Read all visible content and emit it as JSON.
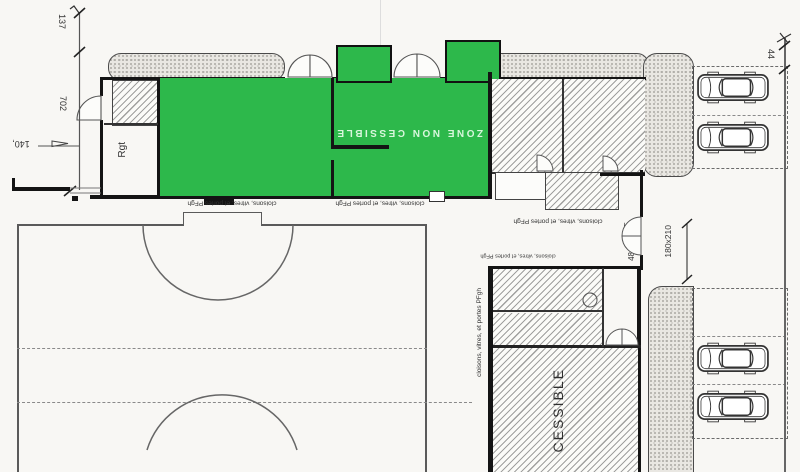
{
  "plan": {
    "green_zone_label": "ZONE NON CESSIBLE",
    "cessible_label": "CESSIBLE",
    "room_label": "Rgt",
    "partition_note": "cloisons, vitres, et portes PFgh",
    "dimensions": {
      "left_upper": "137",
      "left_main": "702",
      "left_offset": "140,",
      "right_setback": "44",
      "door_size": "180x210",
      "door_width": "15",
      "door_num": "48"
    },
    "parking": {
      "car_count": 4
    },
    "colors": {
      "highlight_green": "#2db84b",
      "paper": "#f8f7f4",
      "ink": "#333333"
    }
  }
}
